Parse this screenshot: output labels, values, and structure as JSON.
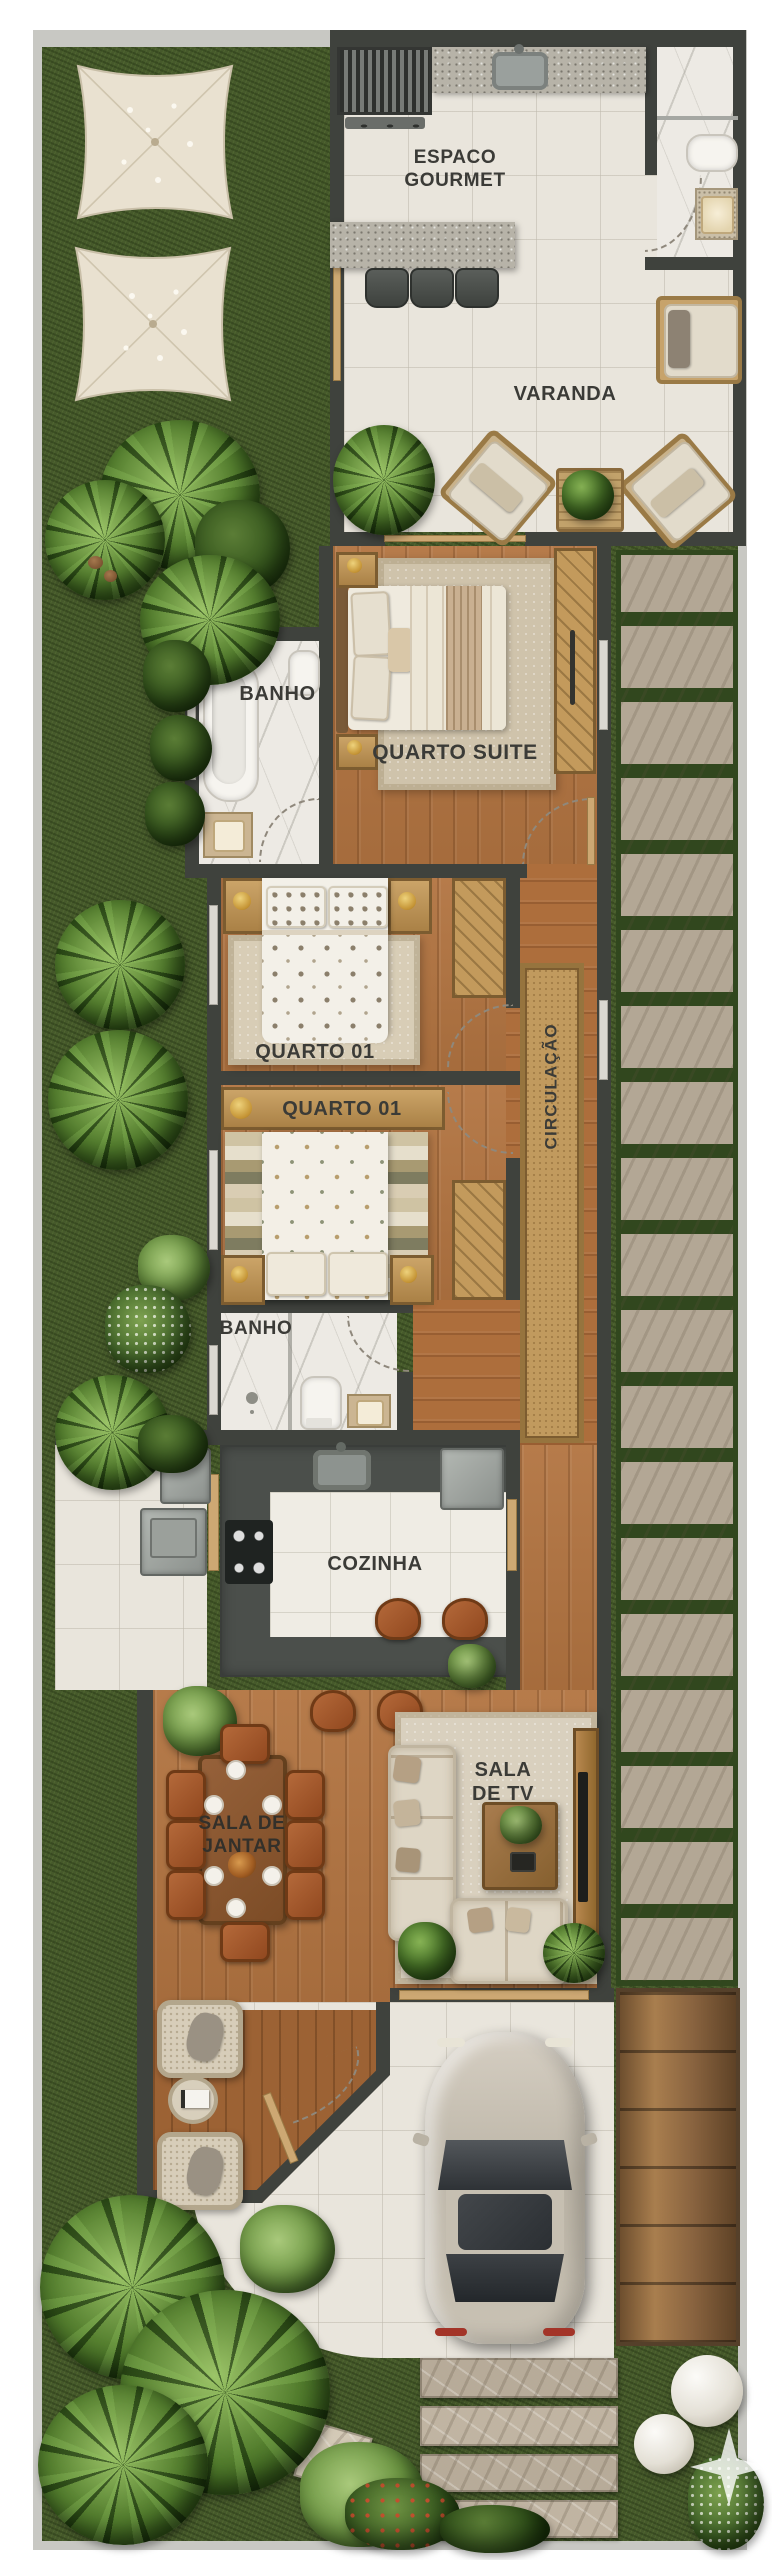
{
  "plan": {
    "type": "residential-floor-plan",
    "view": "top-down"
  },
  "labels": {
    "espaco_gourmet": {
      "line1": "ESPACO",
      "line2": "GOURMET"
    },
    "varanda": "VARANDA",
    "banho_suite": "BANHO",
    "quarto_suite": "QUARTO SUITE",
    "quarto_01_a": "QUARTO 01",
    "quarto_01_b": "QUARTO 01",
    "circulacao": "CIRCULAÇÃO",
    "banho_social": "BANHO",
    "cozinha": "COZINHA",
    "sala_de_jantar": {
      "line1": "SALA DE",
      "line2": "JANTAR"
    },
    "sala_de_tv": {
      "line1": "SALA",
      "line2": "DE TV"
    }
  },
  "palette": {
    "background": "#ffffff",
    "grass": "#46592b",
    "wall_dark": "#3f423d",
    "wall_light": "#c8c8c3",
    "tile": "#e9e5dc",
    "wood": "#b27441",
    "marble": "#edeae4",
    "granite": "#b7b3a8",
    "counter_dark": "#4b4f4b",
    "runner": "#c19a5e",
    "rug_beige": "#cfc3ab",
    "stone": "#b7ab99",
    "gate_wood": "#8a6542",
    "car_body": "#c8c1b3",
    "sail": "#e9e1d0",
    "label_text": "#3b3b37"
  },
  "rooms": [
    {
      "id": "espaco-gourmet",
      "items": [
        "grill",
        "counter-sink",
        "bar-counter",
        "bar-stools"
      ]
    },
    {
      "id": "lavabo",
      "items": [
        "toilet",
        "vanity-sink",
        "shower-divider"
      ]
    },
    {
      "id": "varanda",
      "items": [
        "lounge-chair",
        "armchairs",
        "side-table-plant",
        "palm"
      ]
    },
    {
      "id": "quarto-suite",
      "items": [
        "double-bed",
        "nightstands",
        "rug",
        "wardrobe"
      ]
    },
    {
      "id": "banho-suite",
      "items": [
        "bathtub",
        "vanity-sink",
        "toilet"
      ]
    },
    {
      "id": "quarto-01-a",
      "items": [
        "double-bed",
        "nightstands",
        "rug",
        "wardrobe"
      ]
    },
    {
      "id": "quarto-01-b",
      "items": [
        "double-bed",
        "nightstands",
        "striped-rug",
        "wardrobe",
        "headboard-shelf"
      ]
    },
    {
      "id": "banho-social",
      "items": [
        "shower",
        "toilet",
        "vanity-sink"
      ]
    },
    {
      "id": "cozinha",
      "items": [
        "sink",
        "cooktop",
        "refrigerator",
        "island",
        "stools"
      ]
    },
    {
      "id": "servico",
      "items": [
        "washer",
        "appliance"
      ]
    },
    {
      "id": "sala-de-jantar",
      "items": [
        "dining-table",
        "chairs-8",
        "plates",
        "centerpiece"
      ]
    },
    {
      "id": "sala-de-tv",
      "items": [
        "l-sofa",
        "loveseat",
        "coffee-table",
        "tv-console",
        "tv"
      ]
    },
    {
      "id": "porch",
      "items": [
        "wicker-chairs",
        "round-table",
        "book",
        "front-door"
      ]
    },
    {
      "id": "garage",
      "items": [
        "car",
        "wood-gate",
        "sliding-door"
      ]
    },
    {
      "id": "garden",
      "items": [
        "shade-sails",
        "palms",
        "stone-path",
        "stepping-stones",
        "decor-spheres",
        "stone-pads"
      ]
    }
  ],
  "watermark": {
    "icon": "sparkle-icon"
  }
}
